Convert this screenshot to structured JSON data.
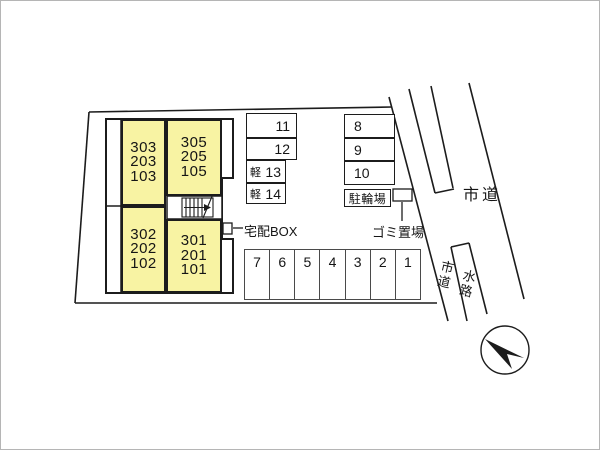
{
  "site_plan": {
    "building": {
      "units": [
        {
          "lines": [
            "303",
            "203",
            "103"
          ]
        },
        {
          "lines": [
            "305",
            "205",
            "105"
          ]
        },
        {
          "lines": [
            "302",
            "202",
            "102"
          ]
        },
        {
          "lines": [
            "301",
            "201",
            "101"
          ]
        }
      ],
      "delivery_box_label": "宅配BOX"
    },
    "parking": {
      "left_column": [
        {
          "prefix": "",
          "number": "11"
        },
        {
          "prefix": "",
          "number": "12"
        },
        {
          "prefix": "軽",
          "number": "13"
        },
        {
          "prefix": "軽",
          "number": "14"
        }
      ],
      "right_column": [
        {
          "number": "8"
        },
        {
          "number": "9"
        },
        {
          "number": "10"
        }
      ],
      "bottom_row": [
        {
          "number": "7"
        },
        {
          "number": "6"
        },
        {
          "number": "5"
        },
        {
          "number": "4"
        },
        {
          "number": "3"
        },
        {
          "number": "2"
        },
        {
          "number": "1"
        }
      ],
      "bicycle_parking_label": "駐輪場",
      "garbage_area_label": "ゴミ置場"
    },
    "roads": {
      "city_road_label_main": "市道",
      "city_road_label_side": "市道",
      "waterway_label": "水路"
    },
    "colors": {
      "unit_fill": "#F8F3A3",
      "line_color": "#1C1C1C"
    }
  }
}
